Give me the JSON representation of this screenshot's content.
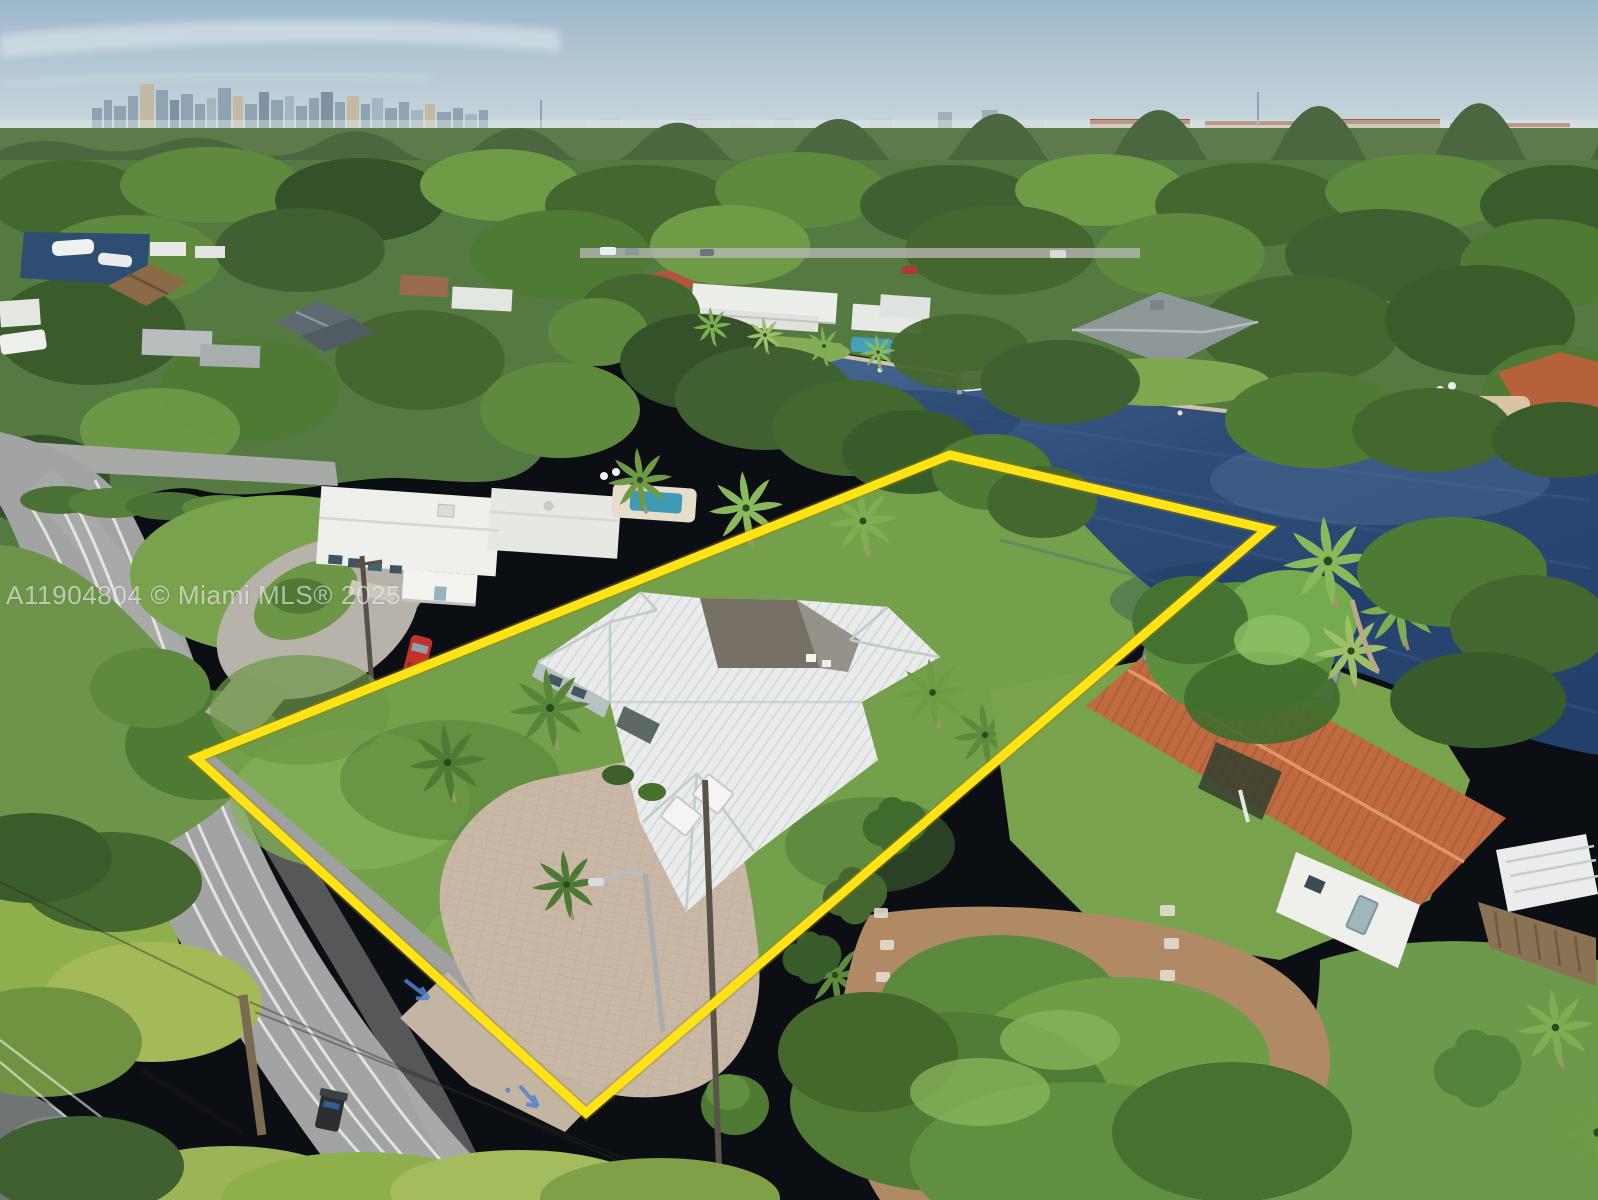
{
  "photo": {
    "kind": "aerial-drone-photograph",
    "description": "Aerial view of a waterfront single-family home on a canal, lot outlined in yellow, city skyline on horizon",
    "width_px": 1598,
    "height_px": 1200
  },
  "watermark": {
    "text": "A11904804 © Miami MLS® 2025"
  },
  "property_boundary": {
    "shape": "quadrilateral",
    "points": "950,455 1267,529 586,1113 196,758",
    "stroke_color": "#ffe315",
    "stroke_width": 9
  },
  "street_markings": {
    "spray_color": "#4f83cf",
    "type": "utility-locate-arrows"
  },
  "palette": {
    "sky_top": "#9db7cb",
    "sky_horizon": "#d7e0e3",
    "skyline_buildings": "#8fa3b2",
    "horizon_trees": "#4a6740",
    "canopy": "#557a41",
    "canopy_dark": "#33522a",
    "canopy_light": "#7da457",
    "water_deep": "#23406a",
    "water_shallow": "#4d6f97",
    "lawn": "#74a04b",
    "road_asphalt": "#a2a4a3",
    "lane_line": "#e8e8e6",
    "paver_driveway": "#c9b8a5",
    "dirt_yard": "#b08a64",
    "white_tile_roof": "#e9eceb",
    "flat_roof": "#777067",
    "terracotta_roof": "#bf6a41",
    "pool_water": "#45a0b8",
    "red_car": "#c2322a",
    "seawall": "#cfc3aa",
    "wood_fence": "#8a7355",
    "boundary_yellow": "#ffe315"
  },
  "scene_labels": {
    "sky": "hazy blue sky",
    "skyline": "downtown high-rise skyline",
    "canal": "dark blue canal",
    "subject_home": "white tile-roof home with circular paver driveway",
    "left_home": "white mid-century home with pool",
    "right_home": "terracotta tile-roof home with dock",
    "road": "residential street with white lane lines"
  }
}
